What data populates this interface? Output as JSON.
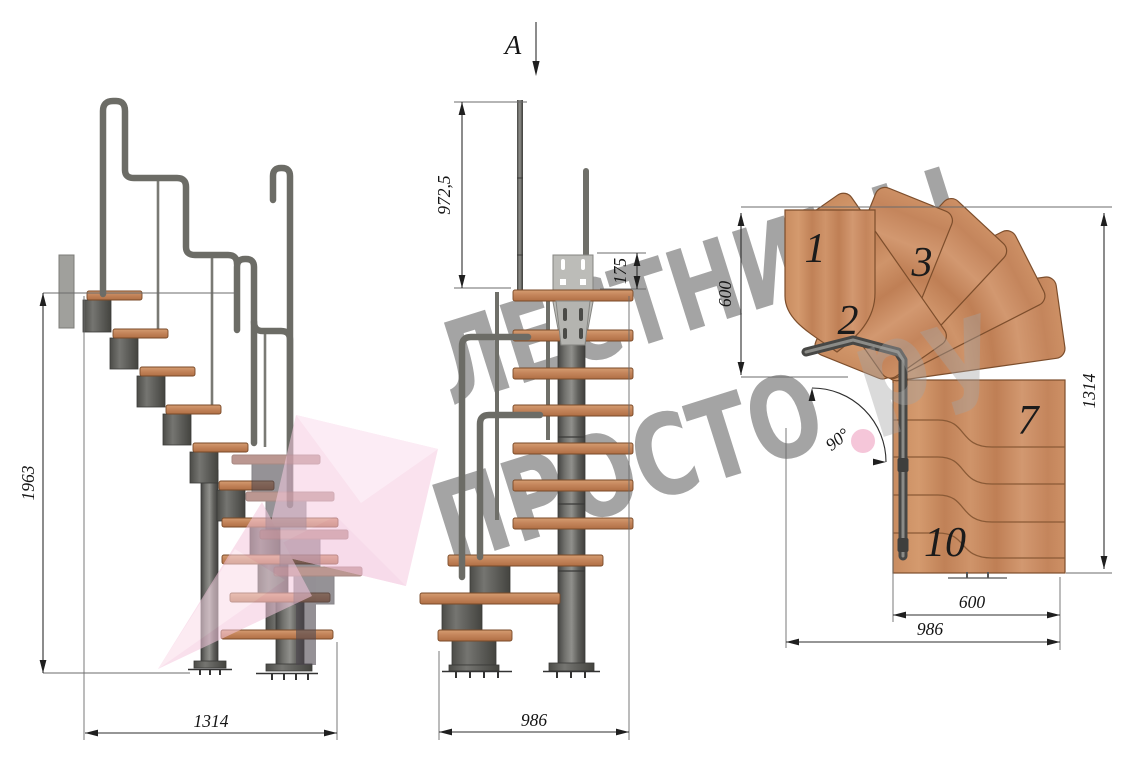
{
  "section": {
    "label": "A"
  },
  "dims": {
    "side_height": "1963",
    "side_length": "1314",
    "front_post_height": "972,5",
    "front_plate_height": "175",
    "front_width": "986",
    "plan_top_depth": "600",
    "plan_length": "1314",
    "plan_bottom_step": "600",
    "plan_width": "986",
    "plan_angle": "90°"
  },
  "plan_steps": {
    "n1": "1",
    "n2": "2",
    "n3": "3",
    "n7": "7",
    "n10": "10"
  },
  "watermark": {
    "line1": "ЛЕСТНИЦЫ",
    "line2": "ПРОСТО",
    "suffix": "ру"
  },
  "colors": {
    "wood": "#c98c60",
    "steel": "#5f5f5b",
    "pink": "#f2a3c2",
    "watermark_gray": "#a4a4a4"
  }
}
